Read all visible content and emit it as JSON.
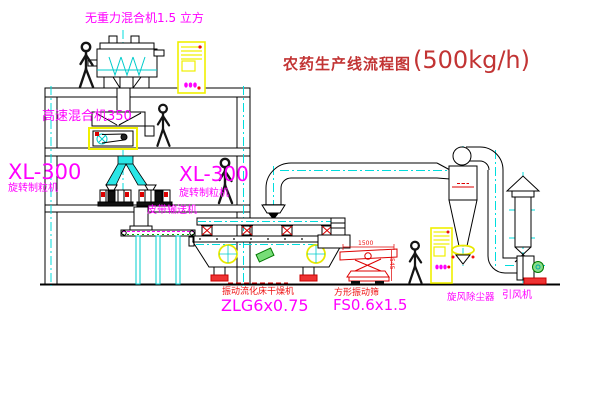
{
  "title": {
    "text_cn": "农药生产线流程图",
    "capacity": "(500kg/h)"
  },
  "labels": {
    "gravity_mixer": "无重力混合机1.5 立方",
    "high_speed_mixer": "高速混合机350",
    "granulator_left_model": "XL-300",
    "granulator_left_name": "旋转制粒机",
    "granulator_right_model": "XL-300",
    "granulator_right_name": "旋转制粒机",
    "belt_conveyor": "皮带输送机",
    "fluid_bed_dryer_name": "振动流化床干燥机",
    "fluid_bed_dryer_model": "ZLG6x0.75",
    "vibrating_screen_name": "方形振动筛",
    "vibrating_screen_model": "FS0.6x1.5",
    "cyclone": "旋风除尘器",
    "induced_draft_fan": "引风机",
    "dim_screen_length": "1500",
    "dim_screen_height": "545"
  },
  "colors": {
    "background": "#ffffff",
    "drawing_line": "#000000",
    "label_magenta": "#ff00ff",
    "label_red": "#ee1111",
    "title_red": "#c23434",
    "centerline_cyan": "#00dddd",
    "chute_cyan": "#2ae6e6",
    "cabinet_yellow": "#f0f000",
    "motor_green": "#22aa22",
    "foot_red": "#ee3333"
  }
}
